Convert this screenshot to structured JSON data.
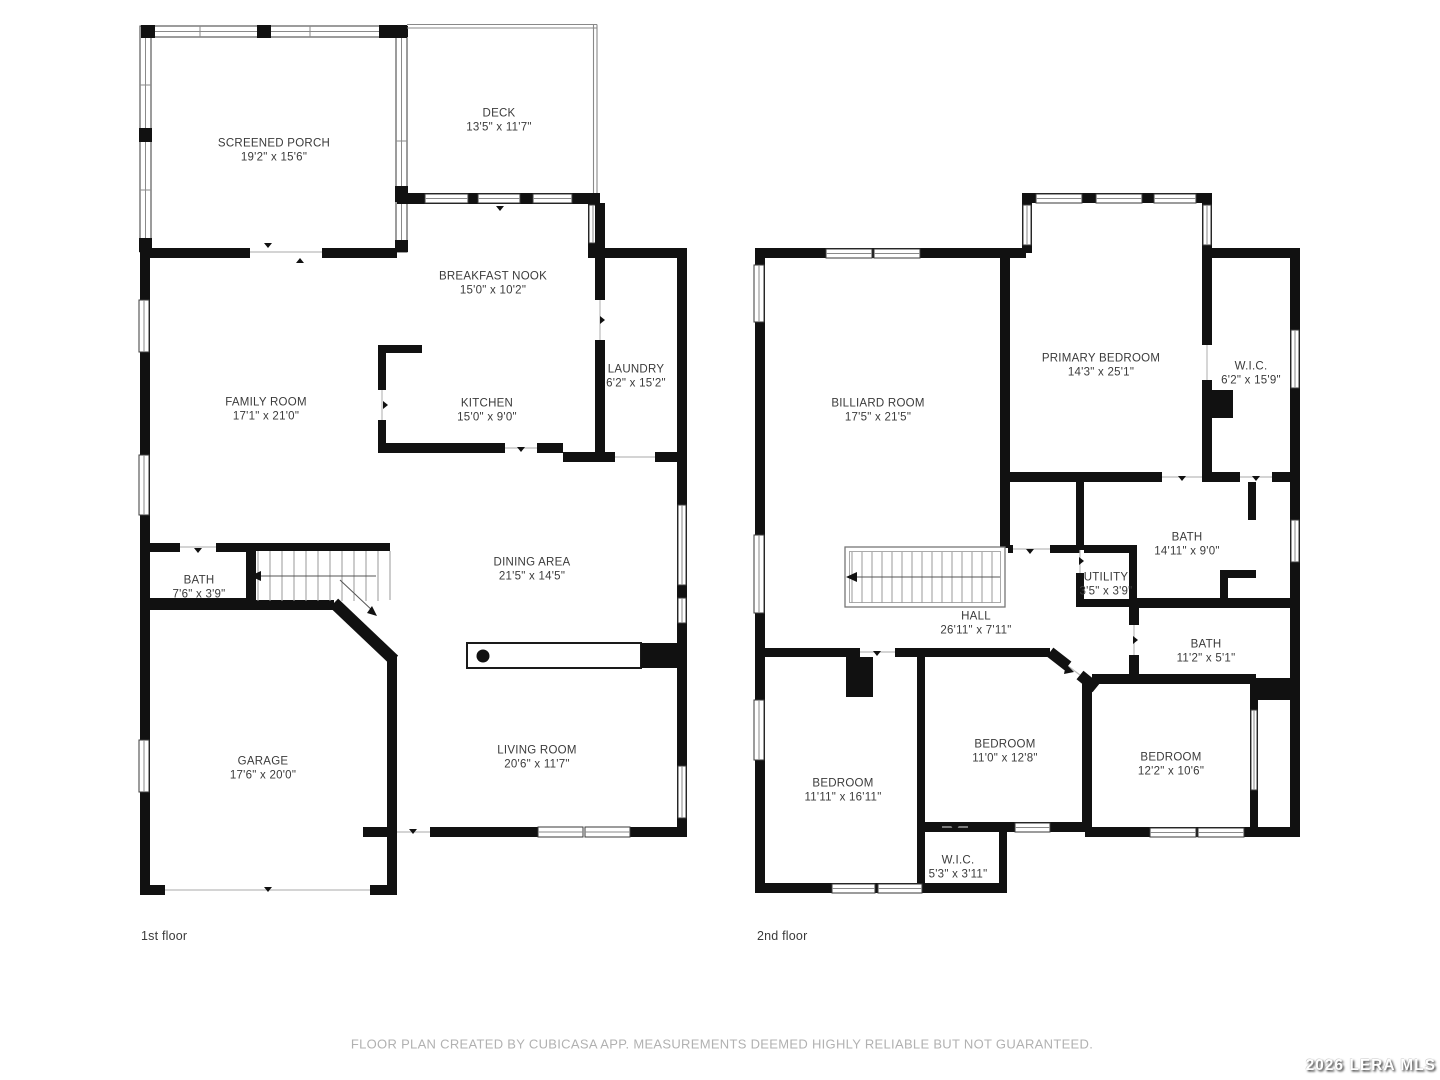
{
  "floor1": {
    "caption": "1st floor",
    "rooms": [
      {
        "name": "SCREENED PORCH",
        "dims": "19'2\" x 15'6\""
      },
      {
        "name": "DECK",
        "dims": "13'5\" x 11'7\""
      },
      {
        "name": "BREAKFAST NOOK",
        "dims": "15'0\" x 10'2\""
      },
      {
        "name": "LAUNDRY",
        "dims": "6'2\" x 15'2\""
      },
      {
        "name": "FAMILY ROOM",
        "dims": "17'1\" x 21'0\""
      },
      {
        "name": "KITCHEN",
        "dims": "15'0\" x 9'0\""
      },
      {
        "name": "DINING AREA",
        "dims": "21'5\" x 14'5\""
      },
      {
        "name": "BATH",
        "dims": "7'6\" x 3'9\""
      },
      {
        "name": "GARAGE",
        "dims": "17'6\" x 20'0\""
      },
      {
        "name": "LIVING ROOM",
        "dims": "20'6\" x 11'7\""
      }
    ]
  },
  "floor2": {
    "caption": "2nd floor",
    "rooms": [
      {
        "name": "BILLIARD ROOM",
        "dims": "17'5\" x 21'5\""
      },
      {
        "name": "PRIMARY BEDROOM",
        "dims": "14'3\" x 25'1\""
      },
      {
        "name": "W.I.C.",
        "dims": "6'2\" x 15'9\""
      },
      {
        "name": "BATH",
        "dims": "14'11\" x 9'0\""
      },
      {
        "name": "UTILITY",
        "dims": "3'5\" x 3'9\""
      },
      {
        "name": "HALL",
        "dims": "26'11\" x 7'11\""
      },
      {
        "name": "BATH",
        "dims": "11'2\" x 5'1\""
      },
      {
        "name": "BEDROOM",
        "dims": "11'11\" x 16'11\""
      },
      {
        "name": "BEDROOM",
        "dims": "11'0\" x 12'8\""
      },
      {
        "name": "BEDROOM",
        "dims": "12'2\" x 10'6\""
      },
      {
        "name": "W.I.C.",
        "dims": "5'3\" x 3'11\""
      }
    ]
  },
  "footer": {
    "disclaimer": "FLOOR PLAN CREATED BY CUBICASA APP. MEASUREMENTS DEEMED HIGHLY RELIABLE BUT NOT GUARANTEED."
  },
  "watermark": {
    "text": "2026 LERA MLS"
  },
  "colors": {
    "wall": "#111111",
    "label_text": "#3b3b3b",
    "disclaimer_text": "#b1b1b1"
  }
}
